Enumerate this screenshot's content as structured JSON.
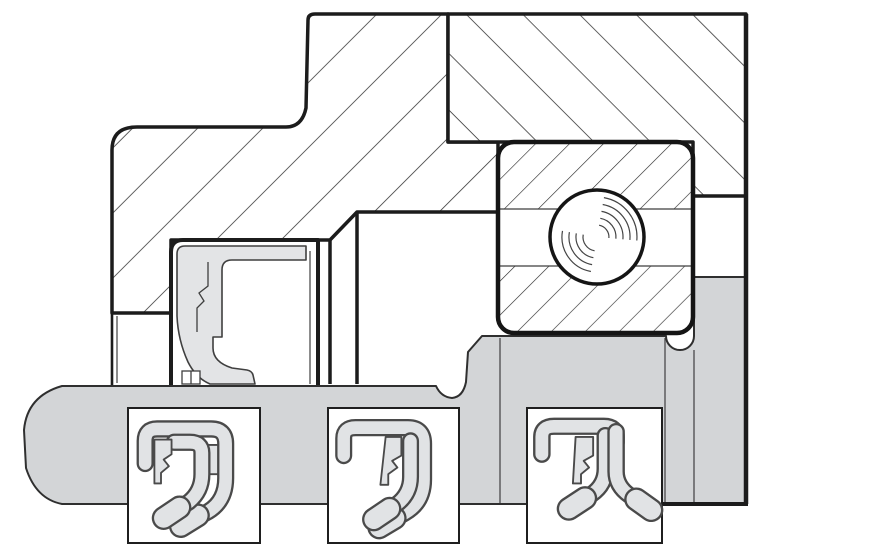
{
  "canvas": {
    "width": 890,
    "height": 556
  },
  "colors": {
    "background": "#ffffff",
    "outline": "#1c1c1c",
    "hatch_line": "#2b2b2b",
    "shaft_fill": "#d3d5d7",
    "shaft_edge": "#2f2f2f",
    "rubber_fill": "#e3e4e6",
    "rubber_edge": "#3f3f3f",
    "inset_band_fill": "#e1e3e5",
    "inset_band_edge": "#4a4a4a",
    "inset_box_fill": "#ffffff"
  },
  "inset_count": 3
}
